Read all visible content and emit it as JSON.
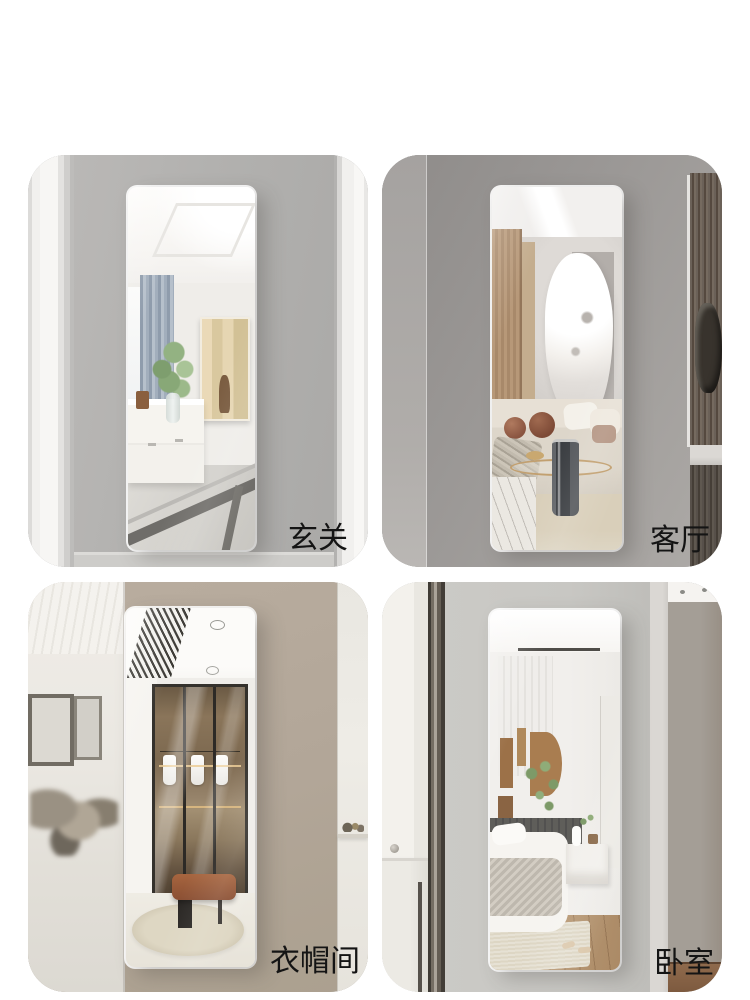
{
  "page": {
    "background_color": "#ffffff",
    "label_color": "#141414"
  },
  "grid": {
    "cards": [
      {
        "scene": "entryway",
        "label": "玄关",
        "wall_color": "#b2b1af"
      },
      {
        "scene": "living-room",
        "label": "客厅",
        "wall_color": "#9a9795"
      },
      {
        "scene": "walk-in-closet",
        "label": "衣帽间",
        "wall_color": "#b2a698"
      },
      {
        "scene": "bedroom",
        "label": "卧室",
        "wall_color": "#c8c7c3"
      }
    ]
  }
}
